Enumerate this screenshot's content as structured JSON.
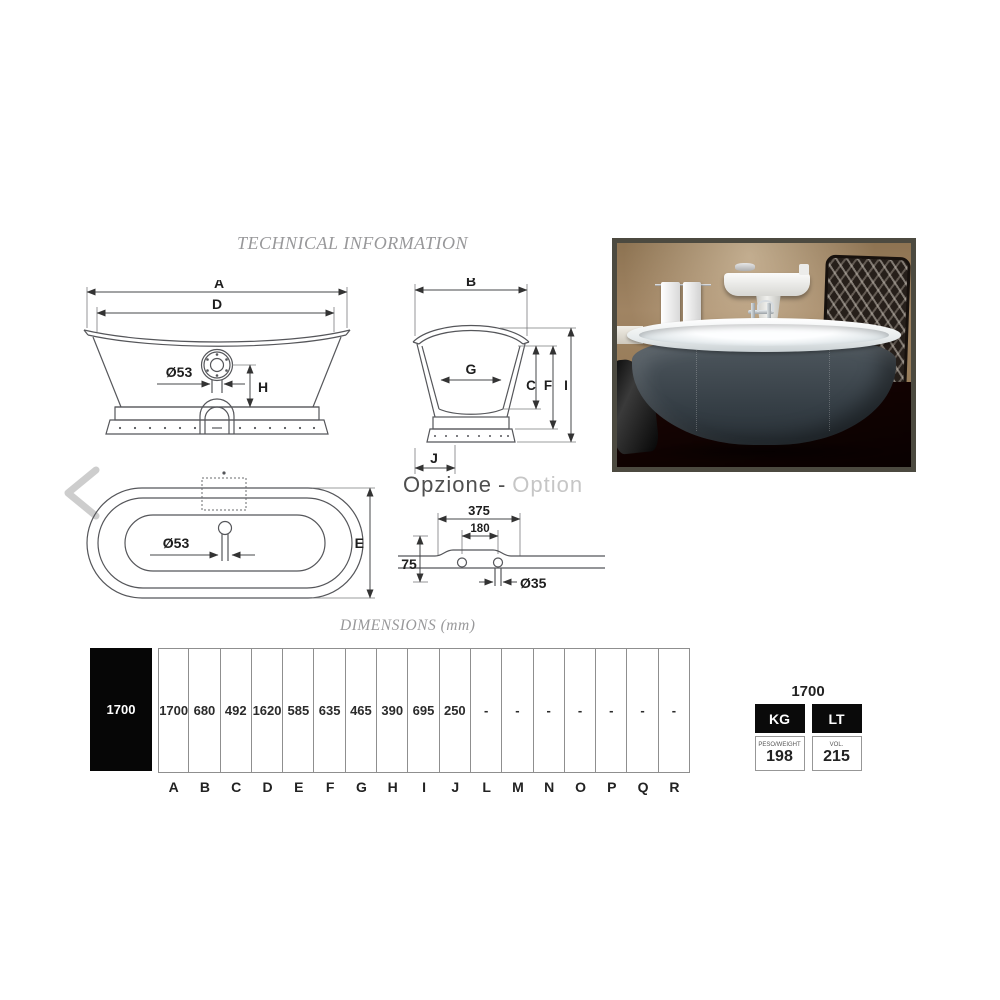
{
  "header": {
    "title": "TECHNICAL INFORMATION"
  },
  "drawings": {
    "side_view": {
      "dim_a": "A",
      "dim_d": "D",
      "drain": "Ø53",
      "dim_h": "H"
    },
    "front_view": {
      "dim_b": "B",
      "dim_g": "G",
      "dim_c": "C",
      "dim_f": "F",
      "dim_i": "I",
      "dim_j": "J"
    },
    "top_view": {
      "drain": "Ø53",
      "dim_e": "E"
    },
    "option": {
      "title_it": "Opzione",
      "title_sep": "-",
      "title_en": "Option",
      "dim_outer": "375",
      "dim_inner": "180",
      "dim_height": "75",
      "dim_hole": "Ø35"
    }
  },
  "dimensions_table": {
    "caption": "DIMENSIONS (mm)",
    "model": "1700",
    "columns": [
      {
        "letter": "A",
        "value": "1700"
      },
      {
        "letter": "B",
        "value": "680"
      },
      {
        "letter": "C",
        "value": "492"
      },
      {
        "letter": "D",
        "value": "1620"
      },
      {
        "letter": "E",
        "value": "585"
      },
      {
        "letter": "F",
        "value": "635"
      },
      {
        "letter": "G",
        "value": "465"
      },
      {
        "letter": "H",
        "value": "390"
      },
      {
        "letter": "I",
        "value": "695"
      },
      {
        "letter": "J",
        "value": "250"
      },
      {
        "letter": "L",
        "value": "-"
      },
      {
        "letter": "M",
        "value": "-"
      },
      {
        "letter": "N",
        "value": "-"
      },
      {
        "letter": "O",
        "value": "-"
      },
      {
        "letter": "P",
        "value": "-"
      },
      {
        "letter": "Q",
        "value": "-"
      },
      {
        "letter": "R",
        "value": "-"
      }
    ]
  },
  "spec_table": {
    "model": "1700",
    "weight_unit": "KG",
    "weight_label": "PESO/WEIGHT",
    "weight_value": "198",
    "volume_unit": "LT",
    "volume_label": "VOL.",
    "volume_value": "215"
  },
  "colors": {
    "table_header_bg": "#000000",
    "drawing_line": "#55565a",
    "muted_title": "#98989a",
    "option_english": "#c6c6c6",
    "tub_body": "#3e474e",
    "photo_wall": "#9a815f",
    "photo_floor": "#47201a"
  }
}
